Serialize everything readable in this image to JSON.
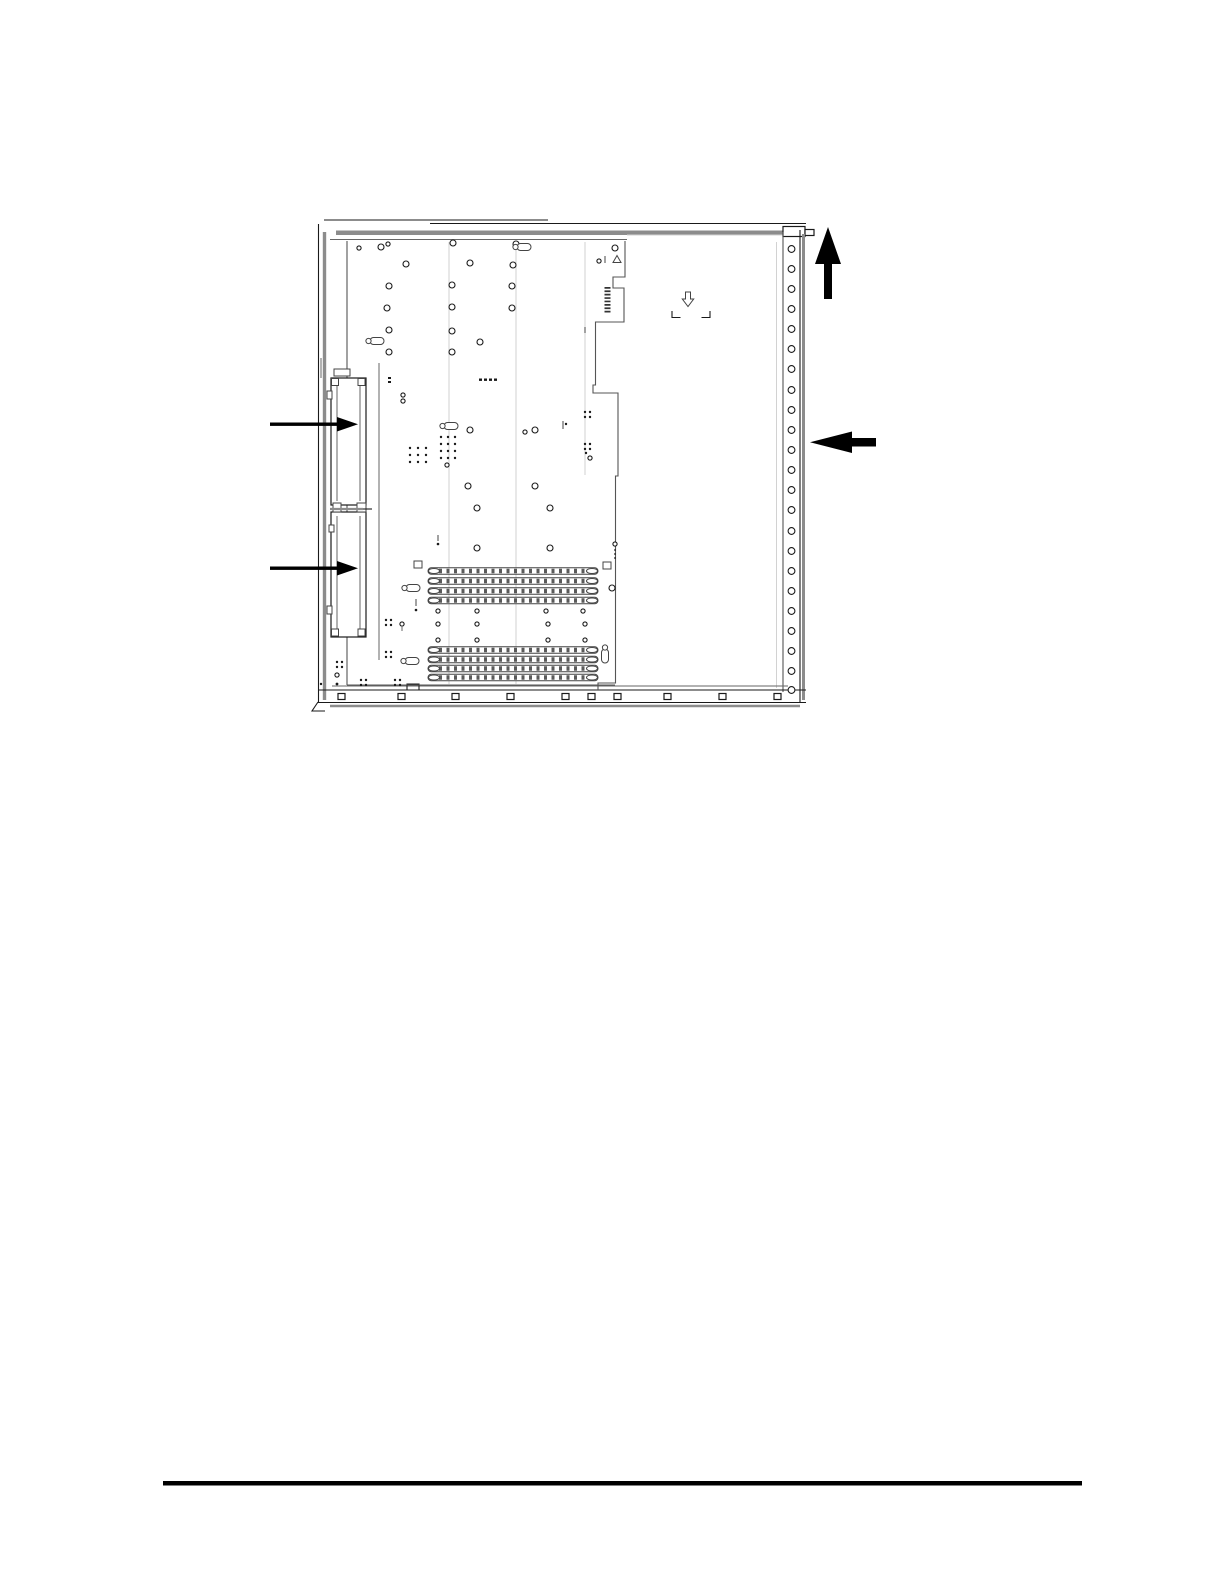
{
  "page": {
    "width": 1224,
    "height": 1584,
    "background": "#ffffff",
    "visible_text": []
  },
  "figure": {
    "kind": "technical-line-drawing",
    "subject": "computer-chassis-system-tray-top-view",
    "colors": {
      "line": "#1a1a1a",
      "shade": "#8c8c8c",
      "accent": "#000000"
    },
    "callouts": [
      {
        "name": "callout-arrow-upper-left",
        "direction": "right"
      },
      {
        "name": "callout-arrow-lower-left",
        "direction": "right"
      },
      {
        "name": "callout-arrow-top-right",
        "direction": "up"
      },
      {
        "name": "callout-arrow-middle-right",
        "direction": "left"
      }
    ],
    "counts": {
      "right_edge_holes": 23,
      "bottom_rail_slots": 10,
      "connector_slot_rows_upper_group": 4,
      "connector_slot_rows_lower_group": 4,
      "left_assembly_sections": 2
    }
  },
  "footer": {
    "has_rule": true
  }
}
